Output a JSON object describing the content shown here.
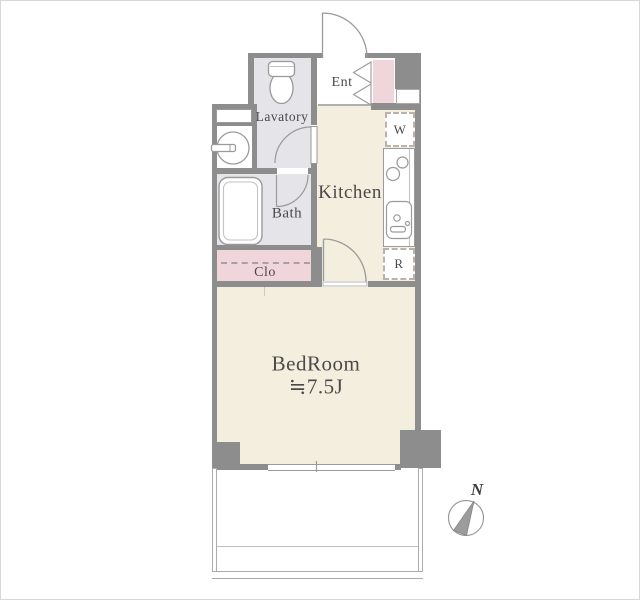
{
  "floorplan": {
    "rooms": {
      "lavatory": {
        "label": "Lavatory"
      },
      "bath": {
        "label": "Bath"
      },
      "closet": {
        "label": "Clo"
      },
      "entrance": {
        "label": "Ent"
      },
      "kitchen": {
        "label": "Kitchen"
      },
      "bedroom": {
        "label": "BedRoom",
        "size": "≒7.5J"
      }
    },
    "appliances": {
      "washer": {
        "label": "W"
      },
      "refrigerator": {
        "label": "R"
      }
    },
    "compass": {
      "label": "N"
    },
    "colors": {
      "wall": "#8d8d8d",
      "wet_area_floor": "#e4e4e9",
      "living_floor": "#f3eedd",
      "closet_pink": "#f0d6da",
      "outline": "#9a9a9a"
    }
  }
}
